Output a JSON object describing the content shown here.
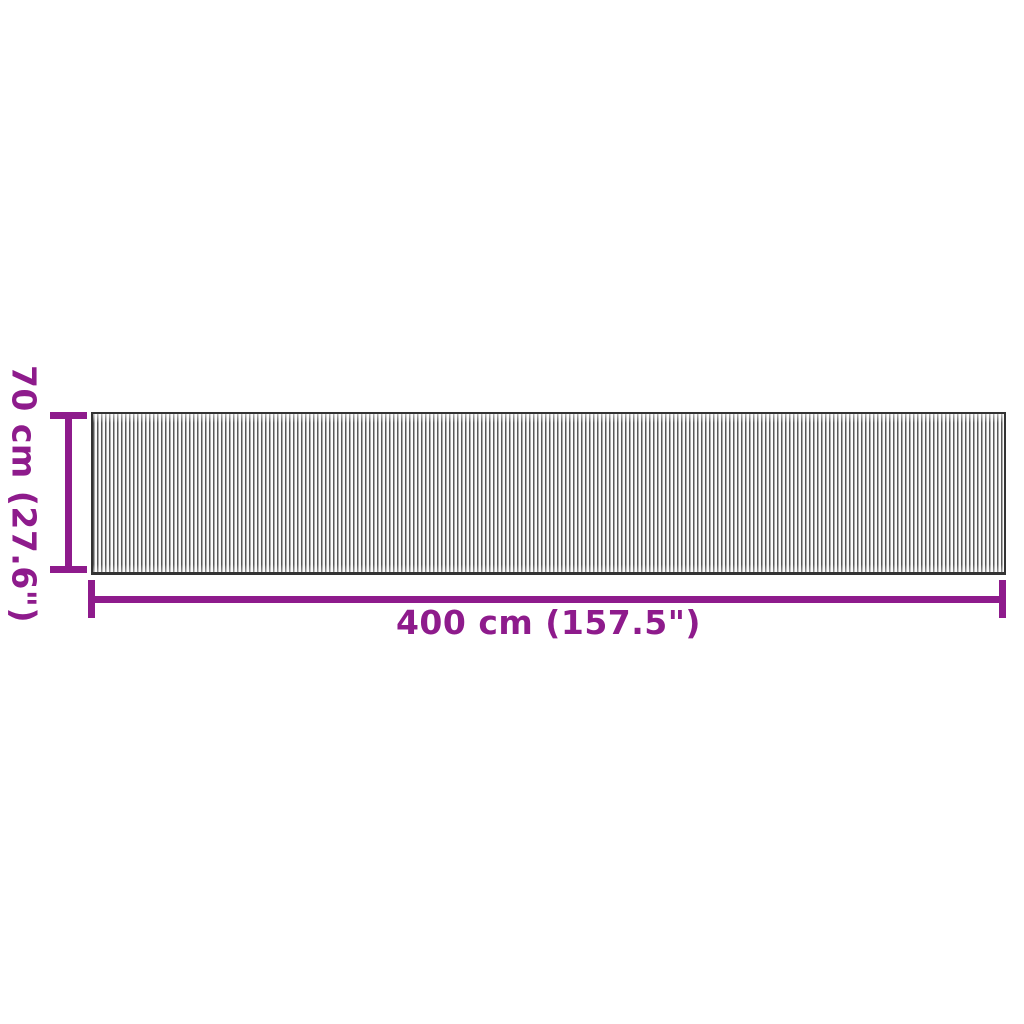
{
  "diagram": {
    "kind": "product-dimension-diagram",
    "product_graphic": "striped-rug",
    "height_dimension": {
      "label": "70 cm (27.6\")",
      "value_cm": 70,
      "value_inches": 27.6,
      "orientation": "vertical"
    },
    "width_dimension": {
      "label": "400 cm (157.5\")",
      "value_cm": 400,
      "value_inches": 157.5,
      "orientation": "horizontal"
    }
  },
  "colors": {
    "accent": "#8e1b8c",
    "rug_stripe_dark": "#585858",
    "rug_stripe_light": "#fafafa",
    "rug_border": "#333333",
    "bg": "#ffffff"
  }
}
